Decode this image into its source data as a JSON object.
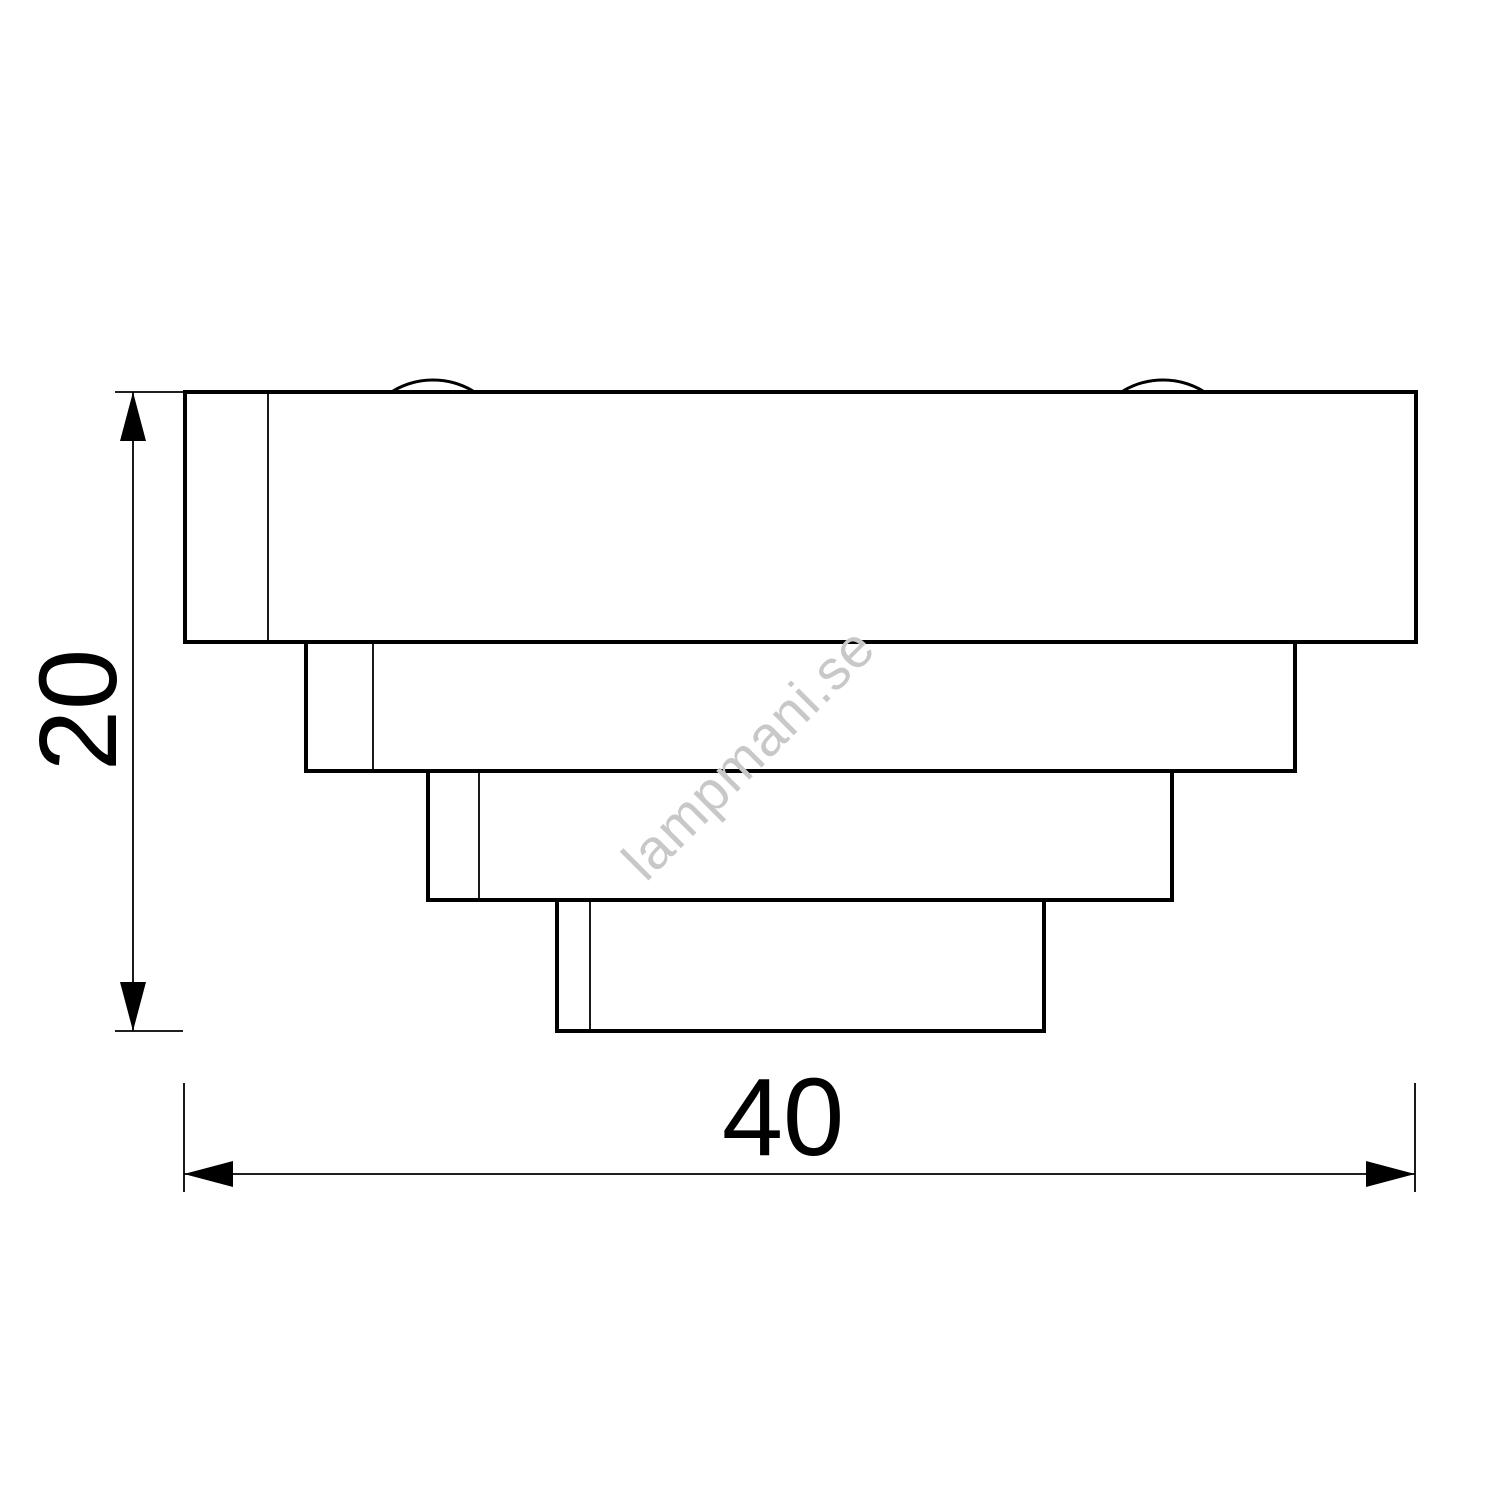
{
  "drawing": {
    "kind": "technical-dimension-drawing",
    "subject": "stepped-lamp-side-profile",
    "tier_count": 4,
    "stroke_color": "#000000",
    "background_color": "#ffffff",
    "dimensions": {
      "height_label": "20",
      "width_label": "40"
    },
    "watermark": {
      "text": "lampmani.se",
      "color": "#c8c8c8"
    }
  }
}
